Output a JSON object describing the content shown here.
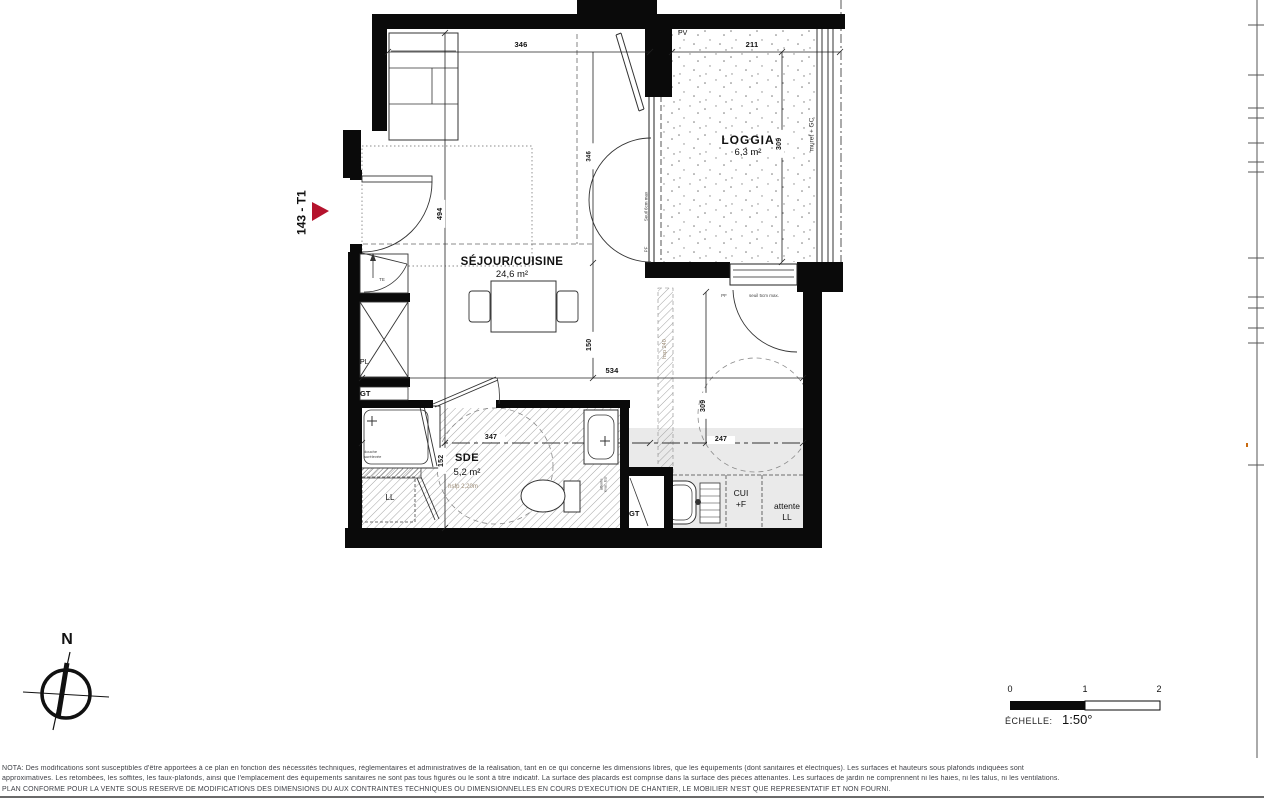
{
  "plan": {
    "lot": "143 - T1",
    "rooms": {
      "sejour_name": "SÉJOUR/CUISINE",
      "sejour_area": "24,6 m²",
      "loggia_name": "LOGGIA",
      "loggia_area": "6,3 m²",
      "sde_name": "SDE",
      "sde_area": "5,2 m²",
      "sde_height": "hsfp 2,20m"
    },
    "annotations": {
      "pv": "PV",
      "muret": "muret + GC",
      "hsp": "hsp 240",
      "seuil_window": "Seuil 6cm max",
      "pf_window": "PF",
      "seuil_door": "seuil 5cm max.",
      "pf_door": "PF",
      "gt_left": "GT",
      "gt_shaft": "GT",
      "pl": "PL",
      "te": "TE",
      "ll": "LL",
      "douche_line1": "douche",
      "douche_line2": "surélevée",
      "cui_line1": "CUI",
      "cui_line2": "+F",
      "attente_line1": "attente",
      "attente_line2": "LL",
      "evac_line1": "attente",
      "evac_line2": "évac. EU"
    },
    "dimensions": {
      "top_left": "346",
      "top_loggia": "211",
      "left_vert": "494",
      "window_vert": "346",
      "mid_vert": "150",
      "mid_horiz": "534",
      "loggia_vert": "309",
      "hall_vert": "309",
      "sde_horiz": "347",
      "sde_vert": "152",
      "hall_horiz": "247"
    }
  },
  "scalebar": {
    "tick0": "0",
    "tick1": "1",
    "tick2": "2",
    "caption": "ÉCHELLE:",
    "value": "1:50°"
  },
  "compass": {
    "north": "N"
  },
  "notes": {
    "line1": "NOTA: Des modifications sont susceptibles d'être apportées à ce plan en fonction des nécessités techniques, réglementaires et administratives de la réalisation, tant en ce qui concerne les dimensions libres, que les équipements (dont sanitaires et électriques). Les surfaces et hauteurs sous plafonds indiquées sont",
    "line2": "approximatives. Les retombées, les soffites, les faux-plafonds, ainsi que l'emplacement des équipements sanitaires ne sont pas tous figurés ou le sont à titre indicatif. La surface des placards est comprise dans la surface des pièces attenantes. Les surfaces de jardin ne comprennent ni les haies, ni les talus, ni les ventilations.",
    "line3": "PLAN CONFORME POUR LA VENTE SOUS RESERVE DE MODIFICATIONS DES DIMENSIONS DÛ AUX CONTRAINTES TECHNIQUES OU DIMENSIONNELLES EN COURS D'EXÉCUTION DE CHANTIER, LE MOBILIER N'EST QUE REPRÉSENTATIF ET NON FOURNI."
  },
  "colors": {
    "accent_red": "#b5132d",
    "wall": "#0a0a0a",
    "floor_gray": "#eaeaea"
  }
}
